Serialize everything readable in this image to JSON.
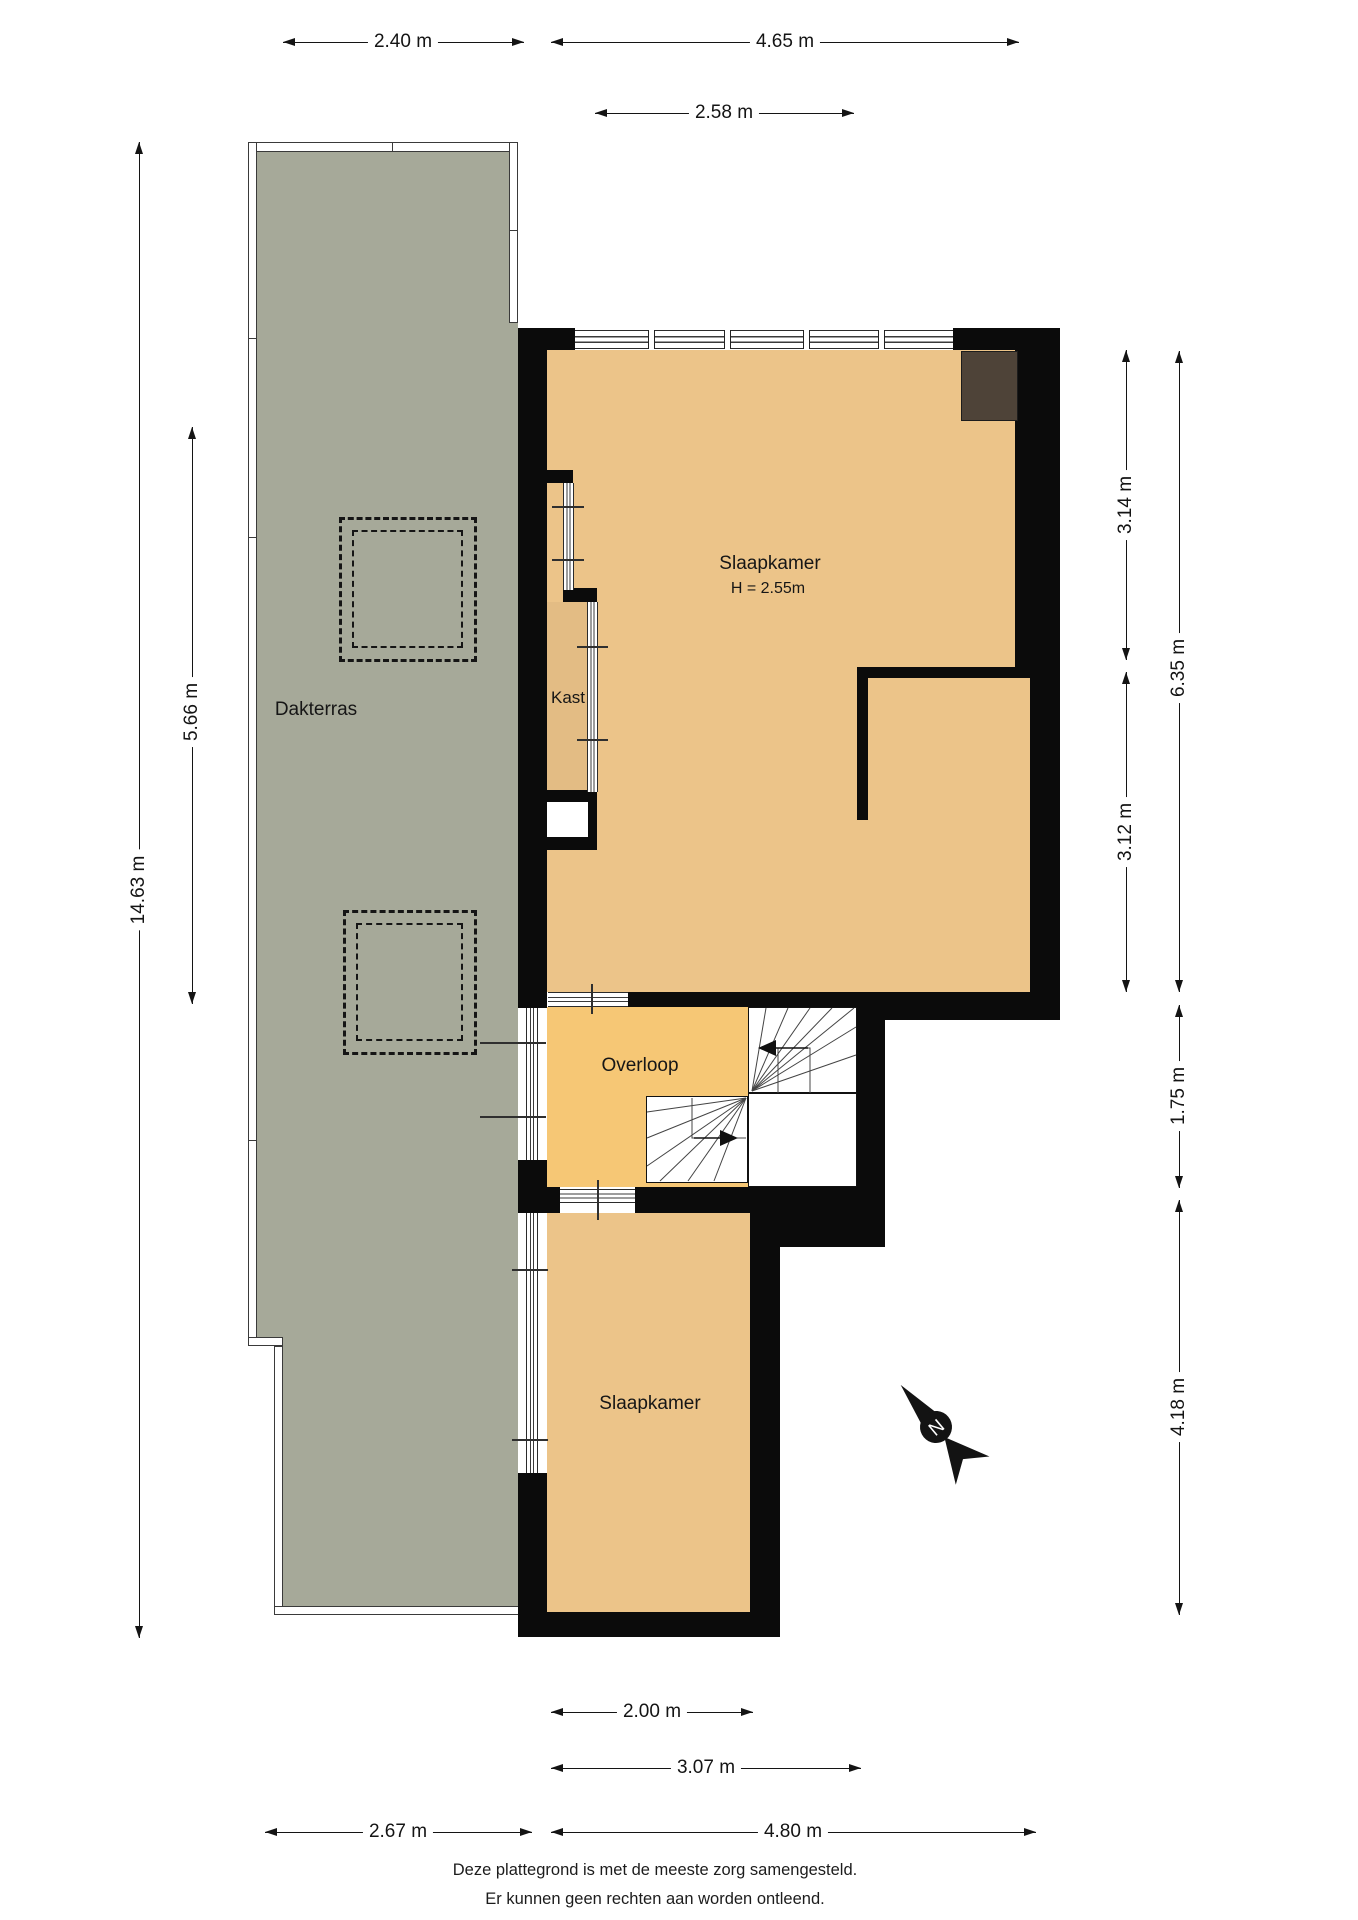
{
  "floorplan": {
    "rooms": {
      "dakterras": {
        "label": "Dakterras"
      },
      "slaapkamer_top": {
        "label": "Slaapkamer",
        "height_label": "H = 2.55m"
      },
      "kast": {
        "label": "Kast"
      },
      "overloop": {
        "label": "Overloop"
      },
      "slaapkamer_bottom": {
        "label": "Slaapkamer"
      }
    },
    "dimensions": {
      "top_terrace": "2.40 m",
      "top_building": "4.65 m",
      "top_window": "2.58 m",
      "left_total": "14.63 m",
      "left_terrace": "5.66 m",
      "right_room_upper": "3.14 m",
      "right_room_lower": "3.12 m",
      "right_total_upper": "6.35 m",
      "right_overloop": "1.75 m",
      "right_bedroom": "4.18 m",
      "bottom_bedroom_inner": "2.00 m",
      "bottom_bedroom_outer": "3.07 m",
      "bottom_building": "4.80 m",
      "bottom_terrace": "2.67 m"
    },
    "compass": {
      "north_label": "N"
    },
    "colors": {
      "terrace_fill": "#a6a999",
      "room_fill": "#ecc489",
      "closet_fill": "#e3bc84",
      "hall_fill": "#f6c775",
      "wall": "#0b0b0b",
      "fixed_object": "#4e4338"
    }
  },
  "footer": {
    "line1": "Deze plattegrond is met de meeste zorg samengesteld.",
    "line2": "Er kunnen geen rechten aan worden ontleend."
  }
}
